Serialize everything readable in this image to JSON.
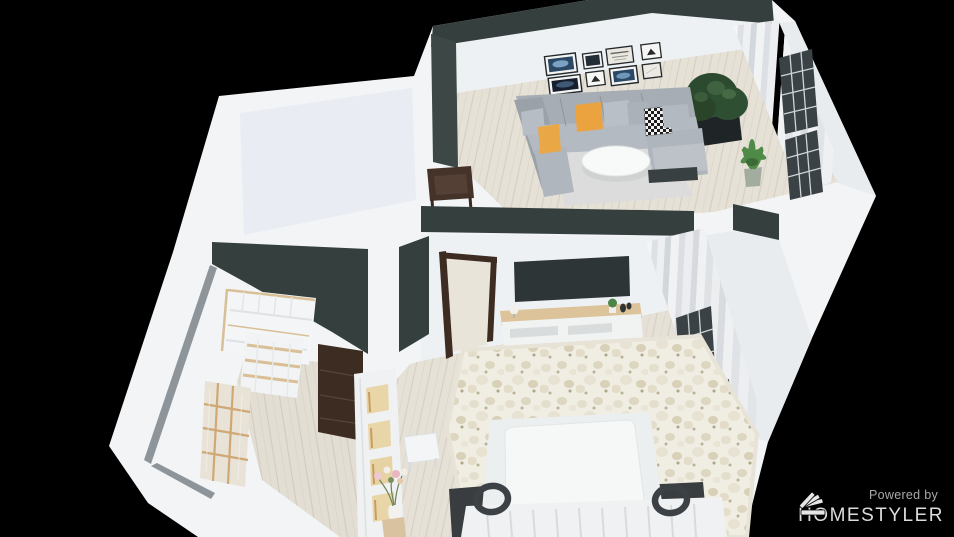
{
  "watermark": {
    "powered_by": "Powered by",
    "brand": "HOMESTYLER"
  },
  "colors": {
    "background": "#000000",
    "wall_white": "#f2f4f6",
    "wall_face": "#eef1f4",
    "wall_side": "#e8ecef",
    "room_interior": "#e9ecf2",
    "accent_dark_wall": "#35403e",
    "cap_gray": "#8e959a",
    "floor_wood": "#e6e1d7",
    "sofa_gray": "#a6adb4",
    "pillow_orange": "#eaa33f",
    "rug_living": "#dadcdd",
    "rug_bedroom": "#f0ede3",
    "tv_dark": "#2e3537",
    "console_wood": "#dcc39a",
    "door_brown": "#3c2c21",
    "side_table_brown": "#45332a",
    "plant_dark": "#2c4a30",
    "plant_light": "#4f8a47",
    "planter_dark": "#1f2426",
    "pot_gray_green": "#a3ad9f",
    "bed_white": "#f6f7f7",
    "lamp_ring_dark": "#3c4145",
    "window_dark": "#3a4246",
    "lit_niche": "#e9d6a8",
    "closet_wood_trim": "#d9bf96",
    "watermark_text": "#dcdcdc",
    "watermark_sub": "#a9a9a9"
  },
  "scene": {
    "type": "3d-floorplan-render",
    "view": "tilted top-down axonometric",
    "rooms": [
      {
        "name": "living-room",
        "objects": [
          "sectional-sofa",
          "orange-pillows",
          "houndstooth-pillow",
          "round-coffee-table",
          "gallery-wall-frames",
          "floor-plant-in-planter",
          "potted-palm",
          "window-curtains",
          "dark-accent-wall",
          "side-table"
        ]
      },
      {
        "name": "closet-room",
        "objects": [
          "cubby-shelving",
          "wine-rack-shelf",
          "glass-door-cabinet",
          "open-wood-door",
          "dark-accent-wall"
        ]
      },
      {
        "name": "bedroom",
        "objects": [
          "bed",
          "slatted-headboard",
          "ring-bedside-lamps",
          "fluffy-area-rug",
          "wall-tv",
          "tv-console",
          "bench",
          "lit-wardrobe",
          "vase-with-flowers",
          "window-curtains",
          "door-frame",
          "dark-accent-band"
        ]
      },
      {
        "name": "empty-room",
        "objects": []
      }
    ]
  }
}
